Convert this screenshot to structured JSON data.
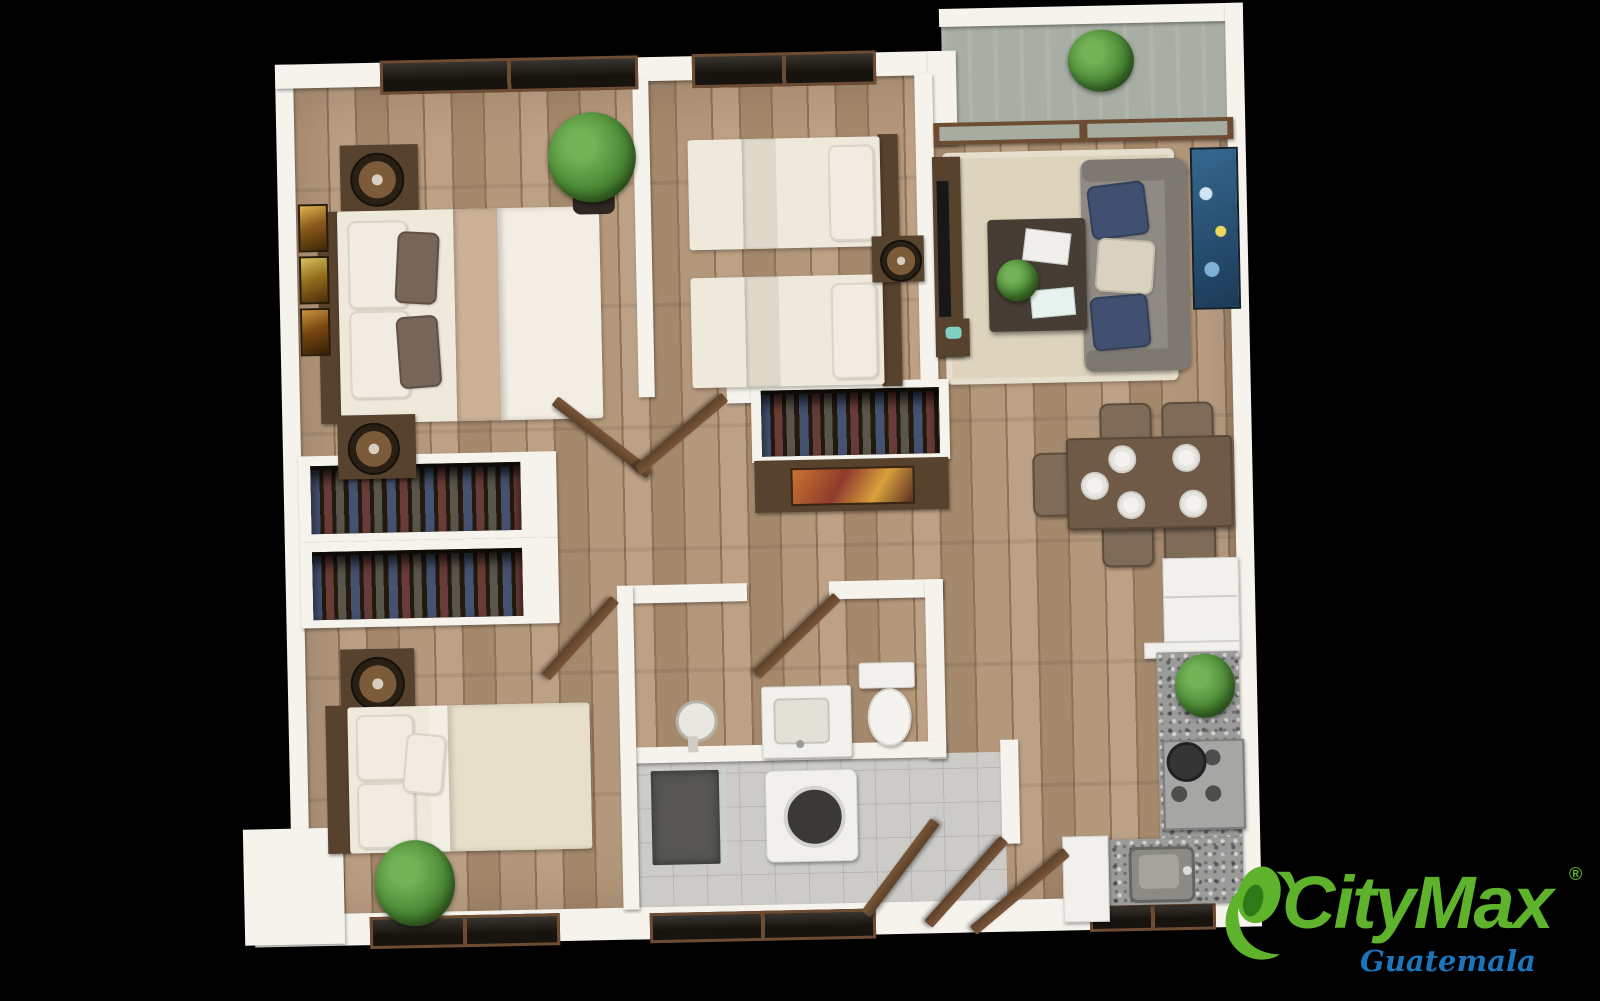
{
  "brand": {
    "name": "CityMax",
    "registered_mark": "®",
    "region": "Guatemala"
  },
  "scene": {
    "type": "apartment-floor-plan-3d-top-view",
    "rooms": [
      "master-bedroom",
      "bedroom-2",
      "bedroom-3",
      "living-room",
      "dining-area",
      "kitchen",
      "bathroom",
      "laundry",
      "balcony",
      "hallway",
      "entrance"
    ]
  },
  "palette": {
    "page_bg": "#000000",
    "brand_green": "#5eb22c",
    "brand_green_dark": "#3c8a1d",
    "region_blue": "#1a75bc",
    "wall": "#f6f3ed",
    "wood_a": "#b4987c",
    "wood_b": "#a5896c",
    "wood_c": "#bda186",
    "wood_line": "#8f7357",
    "balcony_floor": "#a8a79b",
    "tile": "#cccbc7",
    "tile_line": "#b8b7b3",
    "dark_wood": "#57422e",
    "door_wood_1": "#7a5639",
    "door_wood_2": "#5c4129",
    "linen": "#efe9dc",
    "blanket": "#cbb196",
    "pillow_accent": "#776657",
    "closet_dark": "#22190f",
    "sofa": "#8f8a84",
    "sofa_dark": "#7d7872",
    "navy": "#415070",
    "cream": "#d9d2c0",
    "rug": "#ded4bd",
    "table_dark": "#463d34",
    "dining_wood": "#6e5a47",
    "chair": "#7e6b58",
    "granite": "#9b9b99",
    "white_goods": "#f1f0ed",
    "plant": "#4c8a36",
    "plant_dark": "#35671f",
    "window_dark": "#17130e",
    "frame_brown": "#6e4c33"
  }
}
